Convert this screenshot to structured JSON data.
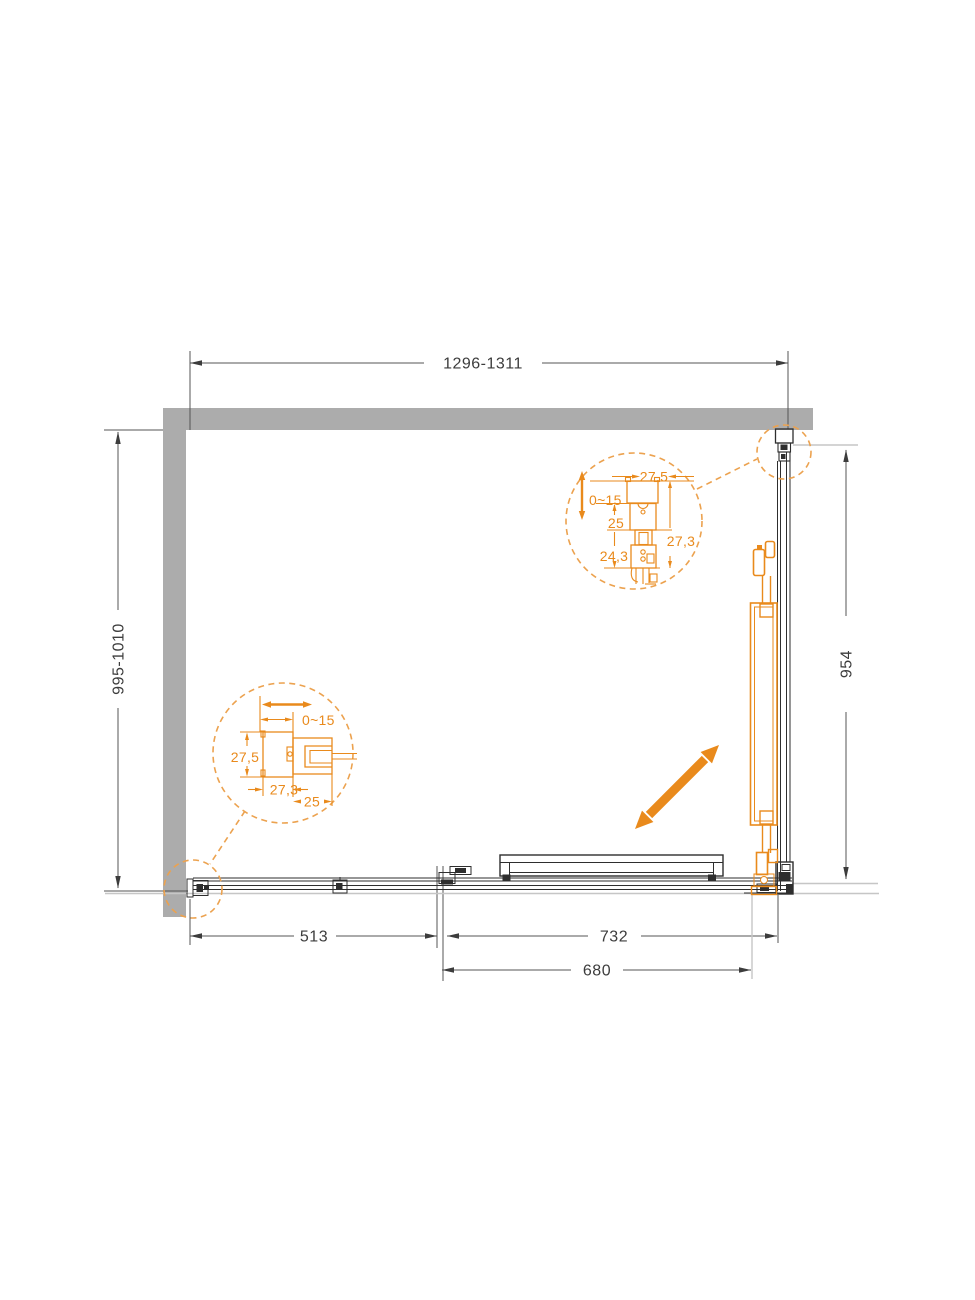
{
  "labels": {
    "width": "1296-1311",
    "depth": "995-1010",
    "side": "954",
    "fixed_panel": "513",
    "opening_outer": "732",
    "opening": "680"
  },
  "detail_top_right": {
    "travel": "0~15",
    "profile_width": "27,5",
    "dim_a": "25",
    "dim_b": "24,3",
    "dim_c": "27,3"
  },
  "detail_bottom_left": {
    "travel": "0~15",
    "profile_width": "27,5",
    "dim_a": "27,3",
    "dim_b": "25"
  },
  "colors": {
    "accent": "#e98a1c",
    "accent_dash": "#eca24f",
    "wall": "#acacac",
    "line": "#2e2e2e"
  }
}
